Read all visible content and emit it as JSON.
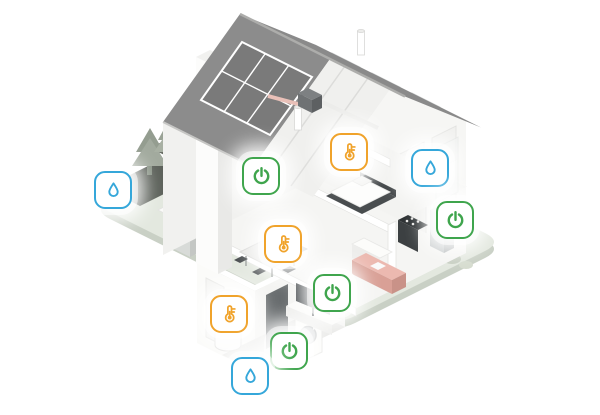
{
  "canvas": {
    "width": 600,
    "height": 415,
    "background": "#ffffff"
  },
  "palette": {
    "roof": "#8c8c8c",
    "roof_inner": "#f0f0ee",
    "solar_panel": "#7a7a7a",
    "wall": "#f4f4f2",
    "wall_shaded": "#efefec",
    "ground": "#e3e8df",
    "ground_edge": "#c9d0c5",
    "sofa_pink": "#ecb9b0",
    "tree_green": "#9fa89c",
    "appliance_dark": "#3c4042",
    "accent_green": "#3fa54d",
    "accent_orange": "#f0a32b",
    "accent_blue": "#35a7da"
  },
  "icons": [
    {
      "id": "water-sensor-outdoor",
      "type": "water",
      "glyph": "droplet-icon",
      "color": "#35a7da",
      "x": 113,
      "y": 190
    },
    {
      "id": "power-control-office",
      "type": "power",
      "glyph": "power-icon",
      "color": "#3fa54d",
      "x": 261,
      "y": 176
    },
    {
      "id": "thermostat-bedroom",
      "type": "temperature",
      "glyph": "thermometer-icon",
      "color": "#f0a32b",
      "x": 349,
      "y": 152
    },
    {
      "id": "water-sensor-bathroom",
      "type": "water",
      "glyph": "droplet-icon",
      "color": "#35a7da",
      "x": 430,
      "y": 168
    },
    {
      "id": "power-control-kitchen",
      "type": "power",
      "glyph": "power-icon",
      "color": "#3fa54d",
      "x": 455,
      "y": 220
    },
    {
      "id": "thermostat-dining",
      "type": "temperature",
      "glyph": "thermometer-icon",
      "color": "#f0a32b",
      "x": 283,
      "y": 244
    },
    {
      "id": "power-control-livingroom",
      "type": "power",
      "glyph": "power-icon",
      "color": "#3fa54d",
      "x": 332,
      "y": 293
    },
    {
      "id": "thermostat-basement",
      "type": "temperature",
      "glyph": "thermometer-icon",
      "color": "#f0a32b",
      "x": 229,
      "y": 314
    },
    {
      "id": "power-control-basement",
      "type": "power",
      "glyph": "power-icon",
      "color": "#3fa54d",
      "x": 289,
      "y": 351
    },
    {
      "id": "water-sensor-basement",
      "type": "water",
      "glyph": "droplet-icon",
      "color": "#35a7da",
      "x": 250,
      "y": 376
    }
  ],
  "scene_elements": [
    "ground-platform",
    "garden-beds",
    "garden-trees",
    "garden-bench",
    "heat-pump",
    "basement",
    "water-heater",
    "basement-door",
    "washing-machine",
    "gable-wall",
    "interior-back-wall",
    "right-end-wall",
    "chimney",
    "roof",
    "solar-panels",
    "vent-pipes",
    "attic-ventilation-unit",
    "office-desk",
    "office-chair",
    "bedroom-bed",
    "bathroom",
    "kitchen-stove",
    "kitchen-fridge",
    "kitchen-island",
    "dining-set",
    "sofa",
    "tv"
  ]
}
